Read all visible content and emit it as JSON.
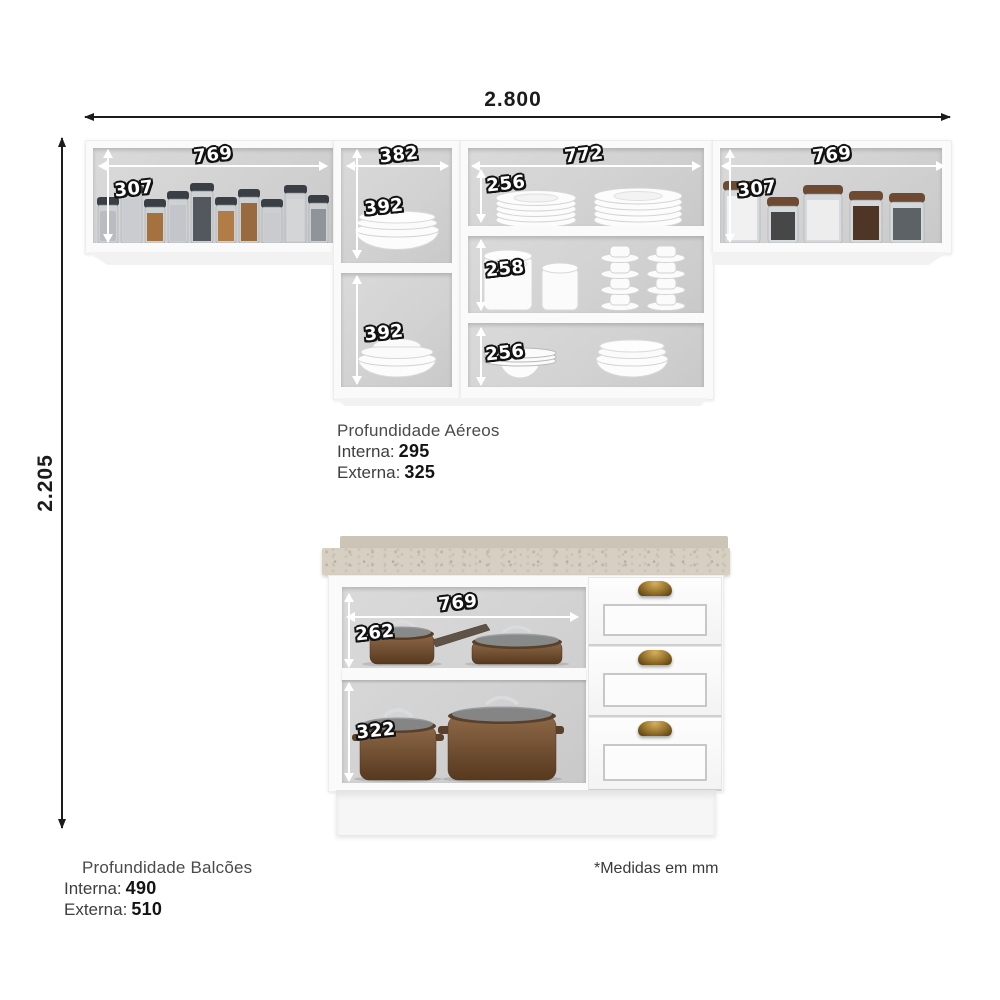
{
  "footnote": "*Medidas em mm",
  "overall": {
    "width_label": "2.800",
    "height_label": "2.205"
  },
  "upper_cabinets": {
    "left_cabinet": {
      "width": "769",
      "height": "307"
    },
    "center_column": {
      "width": "382",
      "upper_height": "392",
      "lower_height": "392"
    },
    "dish_column": {
      "width": "772",
      "shelf1_height": "256",
      "shelf2_height": "258",
      "shelf3_height": "256"
    },
    "right_cabinet": {
      "width": "769",
      "height": "307"
    },
    "depth_note": {
      "title": "Profundidade Aéreos",
      "inner_label": "Interna:",
      "inner_value": "295",
      "outer_label": "Externa:",
      "outer_value": "325"
    }
  },
  "base_cabinet": {
    "open_section": {
      "width": "769",
      "upper_height": "262",
      "lower_height": "322"
    },
    "depth_note": {
      "title": "Profundidade Balcões",
      "inner_label": "Interna:",
      "inner_value": "490",
      "outer_label": "Externa:",
      "outer_value": "510"
    }
  },
  "colors": {
    "dimension_text_fill": "#ffffff",
    "dimension_text_outline": "#121212",
    "outer_dimension_text": "#1b1b1b",
    "cabinet_white": "#fafafa",
    "interior_gray": "#d2d2d2",
    "countertop_beige": "#d6cfc2",
    "pot_brown": "#6f4e31",
    "handle_brass": "#a07c33"
  }
}
